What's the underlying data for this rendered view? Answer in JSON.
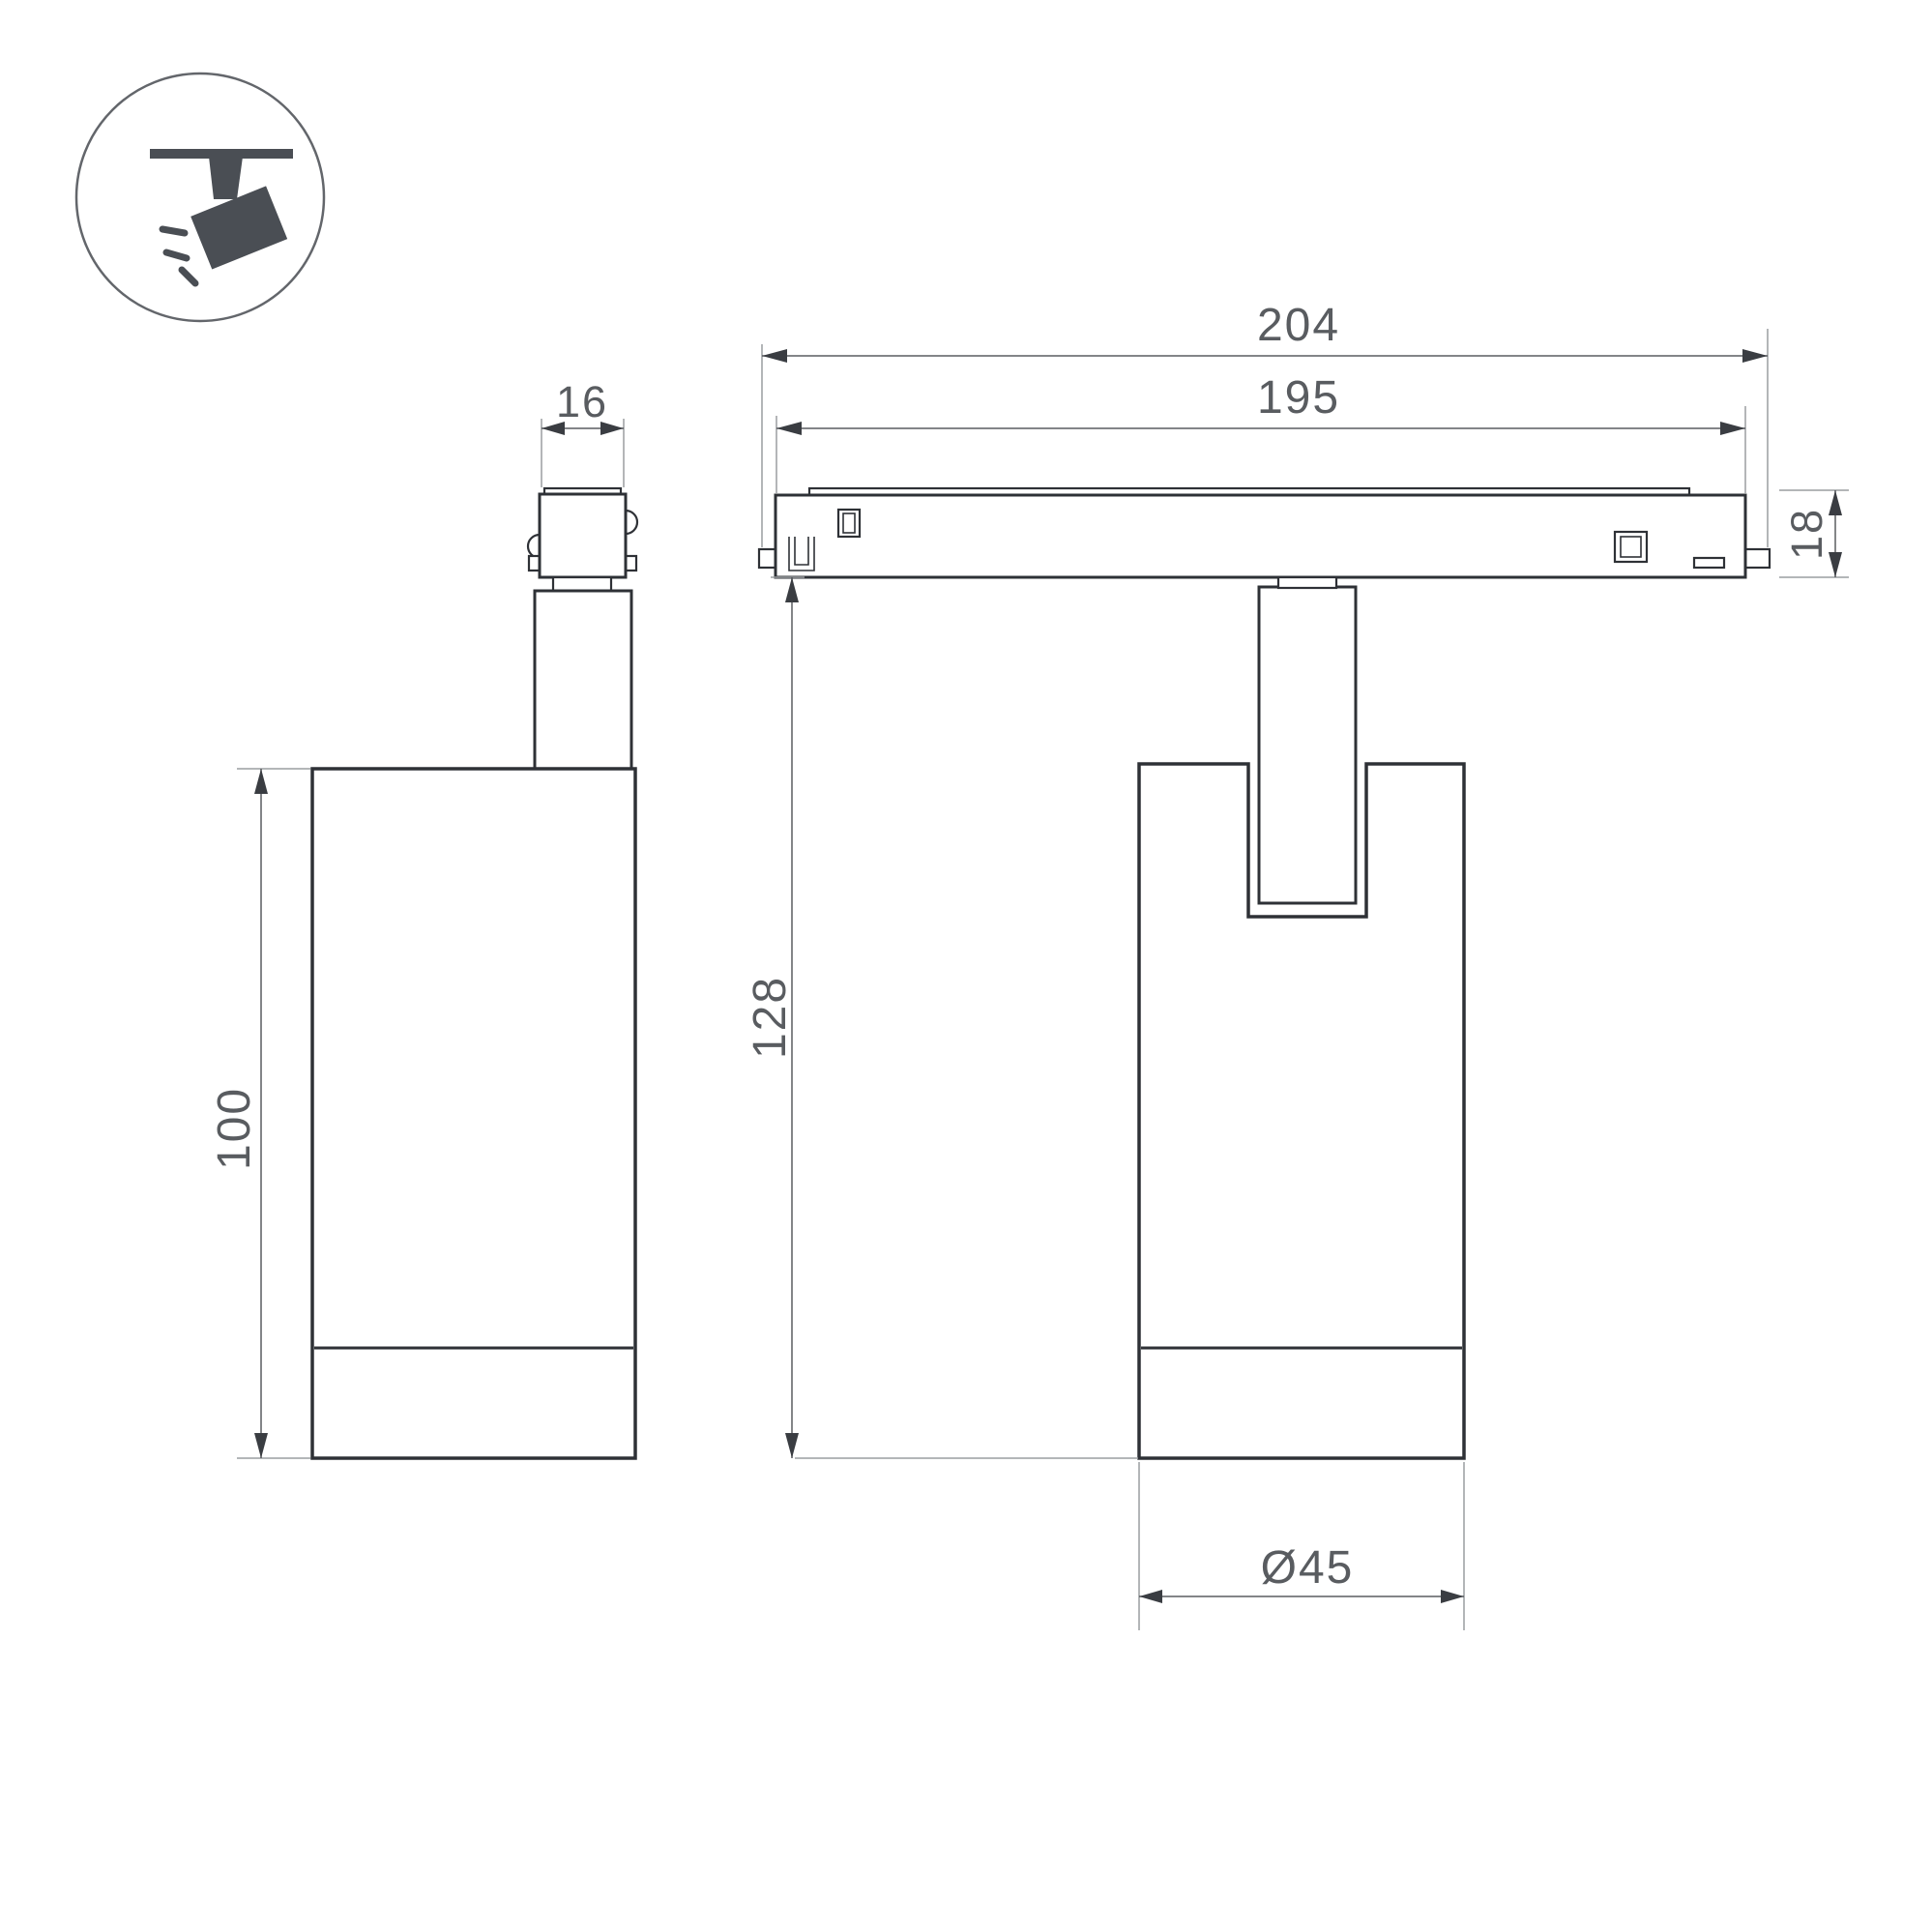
{
  "drawing": {
    "type": "luminaire-dimension-drawing",
    "views": {
      "side_view": "spotlight side view",
      "front_view": "spotlight on track front view",
      "icon": "track-mounted adjustable spotlight pictogram"
    },
    "colors": {
      "background": "#ffffff",
      "outline": "#2e3136",
      "dimension_line": "#5a5d61",
      "extension_line": "#9a9da0",
      "label_text": "#595c60",
      "icon_fill": "#4a4e54"
    }
  },
  "dimensions": {
    "stem_width": "16",
    "body_height": "100",
    "total_length": "204",
    "rail_length": "195",
    "track_height": "18",
    "overall_height": "128",
    "body_diameter": "Ø45"
  }
}
